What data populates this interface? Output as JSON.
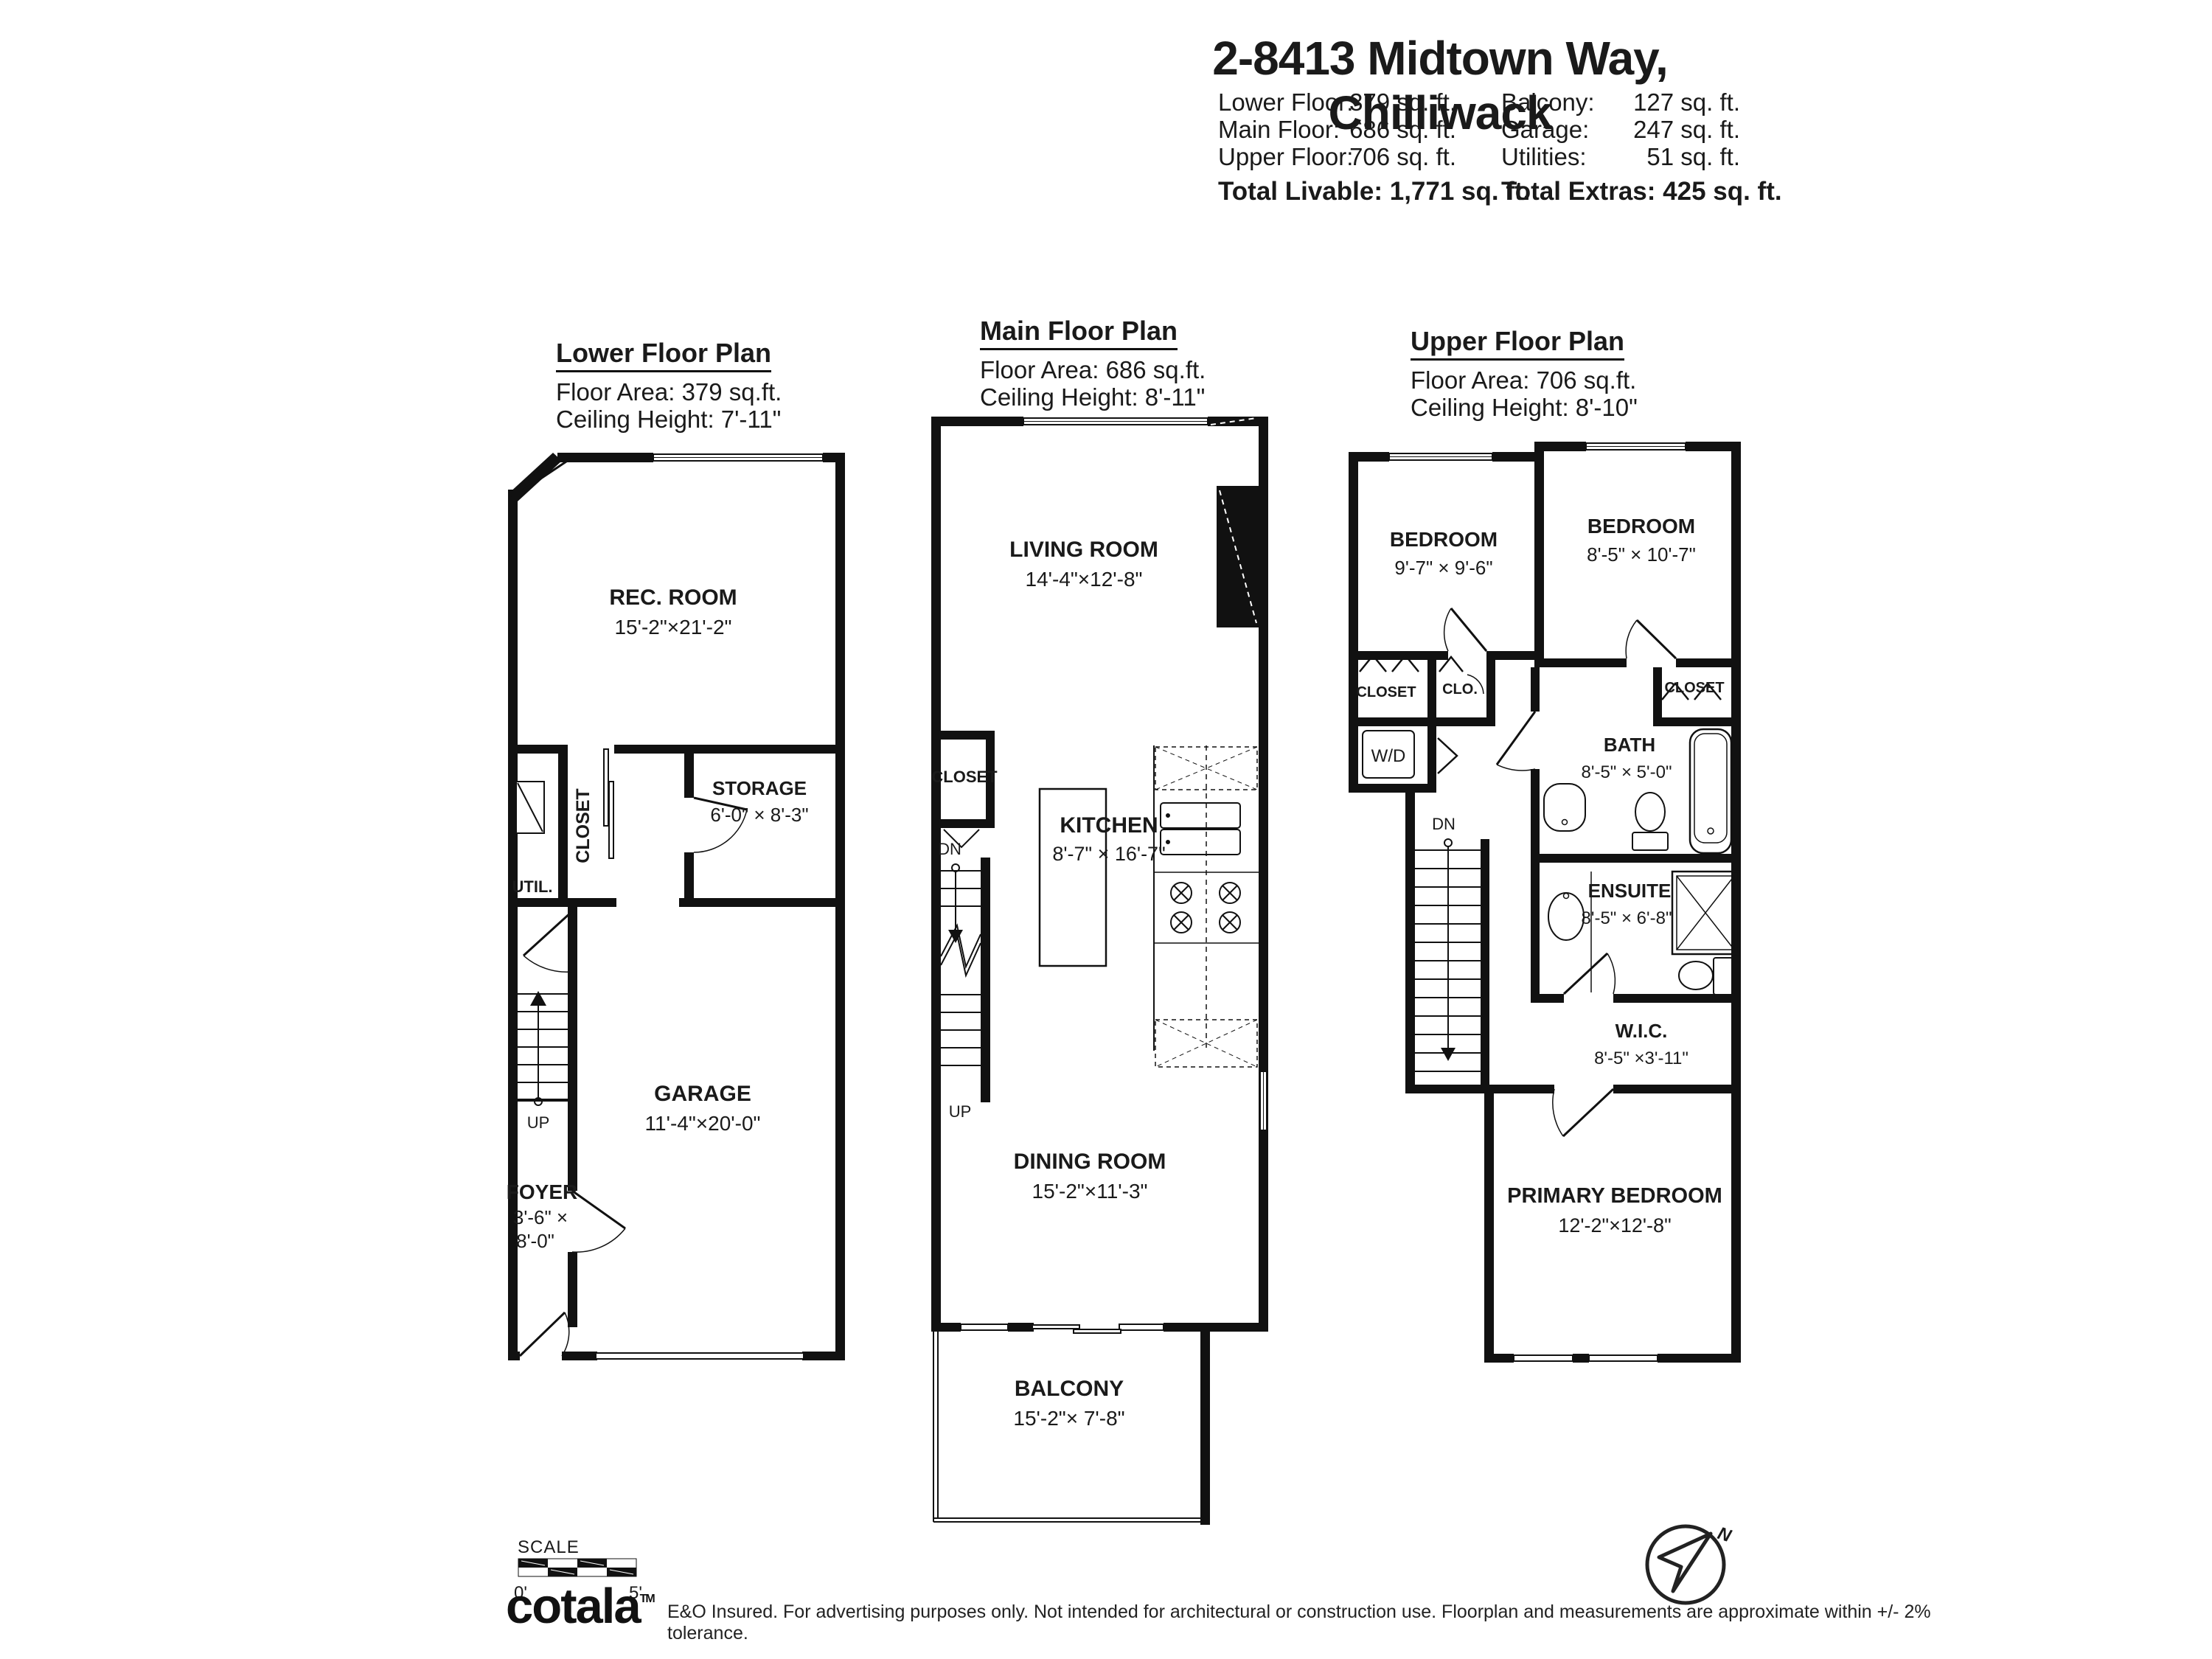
{
  "header": {
    "title": "2-8413 Midtown Way, Chilliwack",
    "area_rows": [
      {
        "l1": "Lower Floor:",
        "v1": "379 sq. ft.",
        "l2": "Balcony:",
        "v2": "127 sq. ft."
      },
      {
        "l1": "Main Floor:",
        "v1": "686 sq. ft.",
        "l2": "Garage:",
        "v2": "247 sq. ft."
      },
      {
        "l1": "Upper Floor:",
        "v1": "706 sq. ft.",
        "l2": "Utilities:",
        "v2": "51 sq. ft."
      }
    ],
    "total_livable_label": "Total Livable:",
    "total_livable_value": "1,771 sq. ft.",
    "total_extras_label": "Total Extras:",
    "total_extras_value": "425 sq. ft."
  },
  "lower": {
    "title": "Lower Floor Plan",
    "area": "Floor Area: 379 sq.ft.",
    "ceiling": "Ceiling Height: 7'-11\"",
    "rec_room": "REC. ROOM",
    "rec_room_dims": "15'-2\"×21'-2\"",
    "closet": "CLOSET",
    "storage": "STORAGE",
    "storage_dims": "6'-0\" × 8'-3\"",
    "util": "UTIL.",
    "garage": "GARAGE",
    "garage_dims": "11'-4\"×20'-0\"",
    "foyer": "FOYER",
    "foyer_dims1": "3'-6\" ×",
    "foyer_dims2": "8'-0\"",
    "up": "UP"
  },
  "main": {
    "title": "Main Floor Plan",
    "area": "Floor Area: 686 sq.ft.",
    "ceiling": "Ceiling Height: 8'-11\"",
    "living_room": "LIVING ROOM",
    "living_room_dims": "14'-4\"×12'-8\"",
    "closet": "CLOSET",
    "kitchen": "KITCHEN",
    "kitchen_dims": "8'-7\" × 16'-7\"",
    "dn": "DN",
    "up": "UP",
    "dining_room": "DINING ROOM",
    "dining_room_dims": "15'-2\"×11'-3\"",
    "balcony": "BALCONY",
    "balcony_dims": "15'-2\"× 7'-8\""
  },
  "upper": {
    "title": "Upper Floor Plan",
    "area": "Floor Area: 706 sq.ft.",
    "ceiling": "Ceiling Height: 8'-10\"",
    "bedroom1": "BEDROOM",
    "bedroom1_dims": "9'-7\" × 9'-6\"",
    "bedroom2": "BEDROOM",
    "bedroom2_dims": "8'-5\" × 10'-7\"",
    "closet1": "CLOSET",
    "clo": "CLO.",
    "closet2": "CLOSET",
    "wd": "W/D",
    "bath": "BATH",
    "bath_dims": "8'-5\" × 5'-0\"",
    "dn": "DN",
    "ensuite": "ENSUITE",
    "ensuite_dims": "8'-5\" × 6'-8\"",
    "wic": "W.I.C.",
    "wic_dims": "8'-5\" ×3'-11\"",
    "primary_bedroom": "PRIMARY BEDROOM",
    "primary_bedroom_dims": "12'-2\"×12'-8\""
  },
  "footer": {
    "scale_label": "SCALE",
    "scale_start": "0'",
    "scale_end": "5'",
    "logo": "cotala",
    "logo_tm": "TM",
    "disclaimer": "E&O Insured. For advertising purposes only. Not intended for architectural or construction use. Floorplan and measurements are approximate within +/- 2% tolerance.",
    "compass_n": "N"
  }
}
